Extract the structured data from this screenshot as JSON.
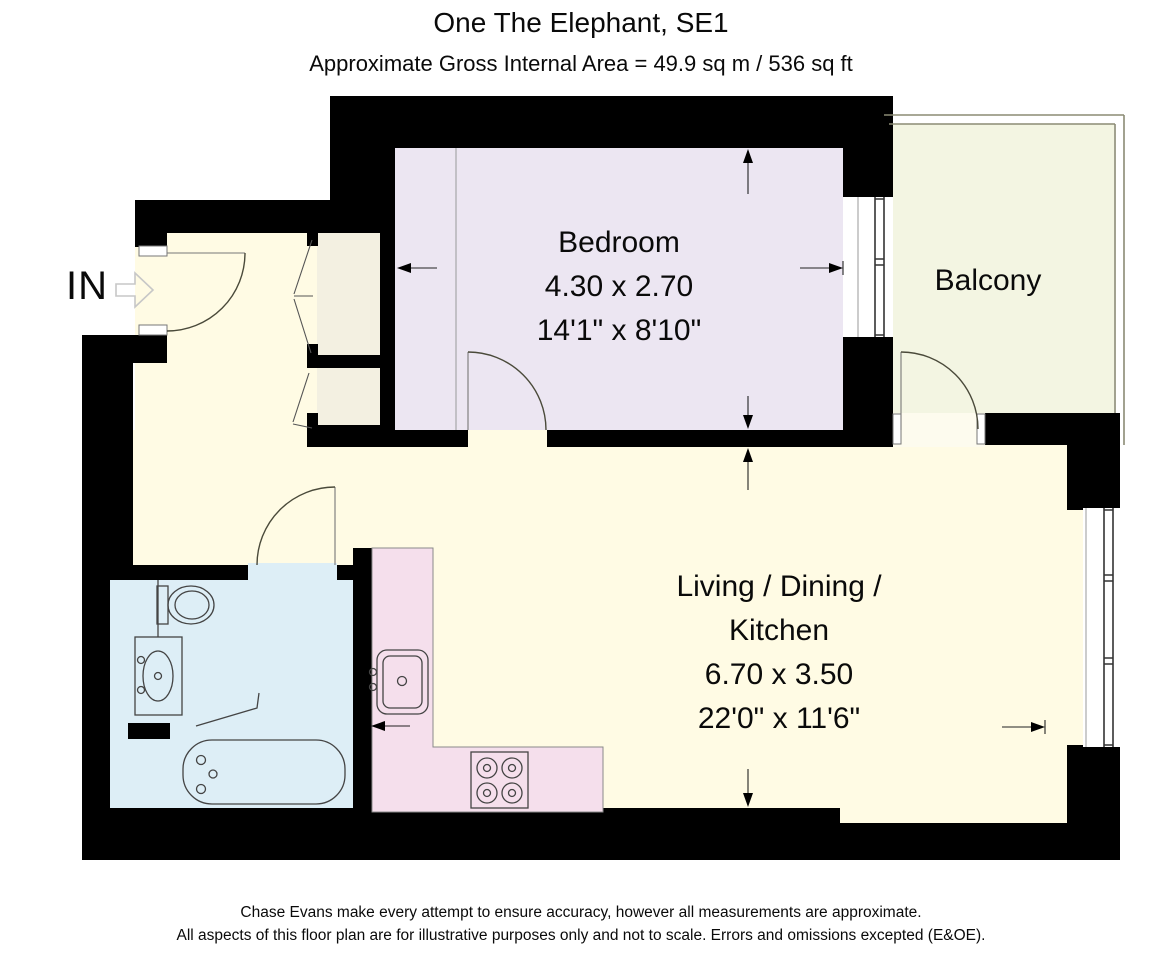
{
  "header": {
    "title": "One The Elephant, SE1",
    "subtitle": "Approximate Gross Internal Area = 49.9 sq m / 536 sq ft"
  },
  "entrance": {
    "label": "IN"
  },
  "rooms": {
    "bedroom": {
      "name": "Bedroom",
      "size_metric": "4.30 x 2.70",
      "size_imperial": "14'1\" x 8'10\"",
      "floor_color": "#ece6f2"
    },
    "living": {
      "name_line1": "Living / Dining /",
      "name_line2": "Kitchen",
      "size_metric": "6.70 x 3.50",
      "size_imperial": "22'0\" x 11'6\"",
      "floor_color": "#fffbe4"
    },
    "balcony": {
      "name": "Balcony",
      "floor_color": "#f3f5e2"
    },
    "bathroom": {
      "floor_color": "#ddeef6"
    },
    "kitchen": {
      "counter_color": "#f5dfec"
    },
    "closets": {
      "floor_color": "#f3f0e1"
    },
    "hallway": {
      "floor_color": "#fffbe4"
    }
  },
  "footer": {
    "line1": "Chase Evans make every attempt to ensure accuracy, however all measurements are approximate.",
    "line2": "All aspects of this floor plan are for illustrative purposes only and not to scale. Errors and omissions excepted (E&OE)."
  },
  "colors": {
    "wall": "#000000",
    "outline": "#4a4a4a",
    "door_threshold": "#fdfbee"
  }
}
